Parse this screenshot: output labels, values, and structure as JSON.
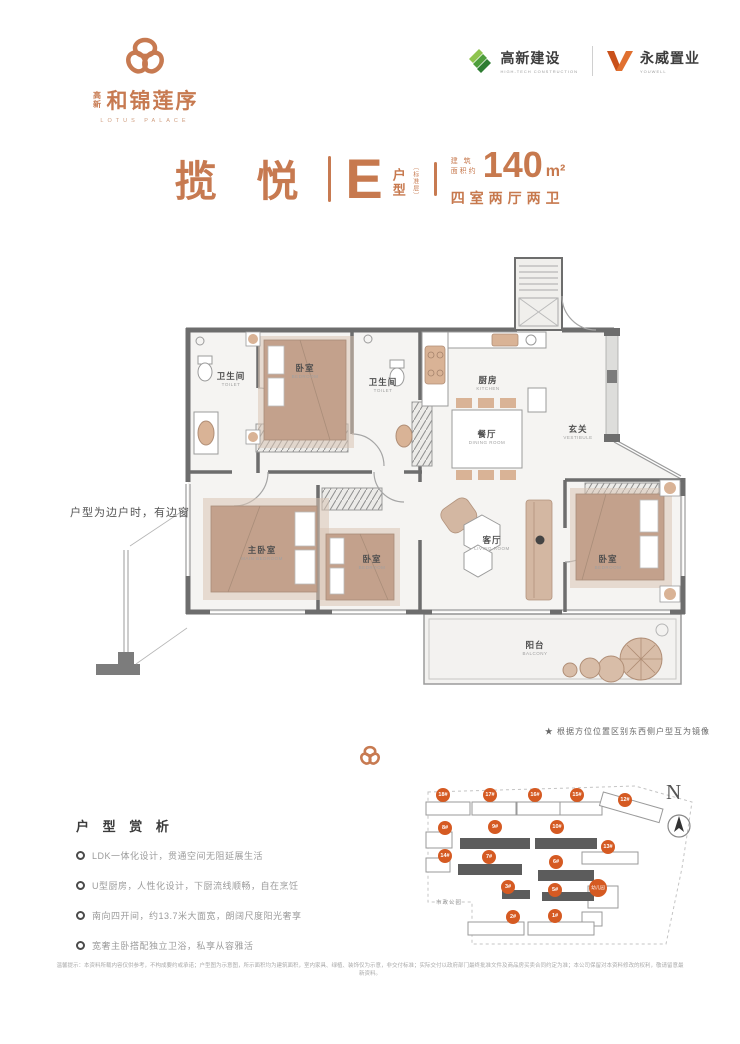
{
  "brand": {
    "logo_prefix": "高新",
    "logo_cn": "和锦莲序",
    "logo_en": "LOTUS PALACE",
    "builder_cn": "高新建设",
    "builder_en": "HIGH-TECH CONSTRUCTION",
    "developer_cn": "永威置业",
    "developer_en": "YOUWELL"
  },
  "title": {
    "name": "揽 悦",
    "unit_letter": "E",
    "unit_word": "户型",
    "unit_note": "〔标准层〕",
    "area_prefix_1": "建 筑",
    "area_prefix_2": "面积约",
    "area_value": "140",
    "area_unit": "m²",
    "rooms_text": "四室两厅两卫"
  },
  "floorplan": {
    "rooms": [
      {
        "cn": "卫生间",
        "en": "TOILET"
      },
      {
        "cn": "卧室",
        "en": "BEDROOM"
      },
      {
        "cn": "卫生间",
        "en": "TOILET"
      },
      {
        "cn": "厨房",
        "en": "KITCHEN"
      },
      {
        "cn": "餐厅",
        "en": "DINING ROOM"
      },
      {
        "cn": "玄关",
        "en": "VESTIBULE"
      },
      {
        "cn": "主卧室",
        "en": "MAIN BEDROOM"
      },
      {
        "cn": "卧室",
        "en": "BEDROOM"
      },
      {
        "cn": "客厅",
        "en": "LIVING ROOM"
      },
      {
        "cn": "卧室",
        "en": "BEDROOM"
      },
      {
        "cn": "阳台",
        "en": "BALCONY"
      }
    ],
    "side_note": "户型为边户时，有边窗",
    "mirror_note": "★ 根据方位位置区别东西侧户型互为镜像"
  },
  "analysis": {
    "title": "户 型 赏 析",
    "bullets": [
      "LDK一体化设计，贯通空间无阻延展生活",
      "U型厨房，人性化设计，下厨流线顺畅，自在烹饪",
      "南向四开间，约13.7米大面宽，朗阔尺度阳光奢享",
      "宽奢主卧搭配独立卫浴，私享从容雅活"
    ]
  },
  "siteplan": {
    "badges": [
      {
        "label": "18#"
      },
      {
        "label": "17#"
      },
      {
        "label": "16#"
      },
      {
        "label": "15#"
      },
      {
        "label": "12#"
      },
      {
        "label": "8#"
      },
      {
        "label": "9#"
      },
      {
        "label": "10#"
      },
      {
        "label": "13#"
      },
      {
        "label": "14#"
      },
      {
        "label": "7#"
      },
      {
        "label": "6#"
      },
      {
        "label": "3#"
      },
      {
        "label": "5#"
      },
      {
        "label": "幼儿园"
      },
      {
        "label": "2#"
      },
      {
        "label": "1#"
      }
    ],
    "park_label": "市政公园",
    "north_label": "N"
  },
  "disclaimer": "温馨提示：本资料所载内容仅供参考，不构成要约或承诺；户型图为示意图，所示面积均为建筑面积，室内家具、绿植、装饰仅为示意，非交付标准；实际交付以政府部门最终批准文件及商品房买卖合同约定为准；本公司保留对本资料修改的权利，敬请留意最新资料。",
  "colors": {
    "accent": "#c77a51",
    "badge_orange": "#d55a22",
    "wall_gray": "#6d6d6d",
    "builder_green": "#4e9e3c",
    "developer_orange": "#c9511b"
  }
}
